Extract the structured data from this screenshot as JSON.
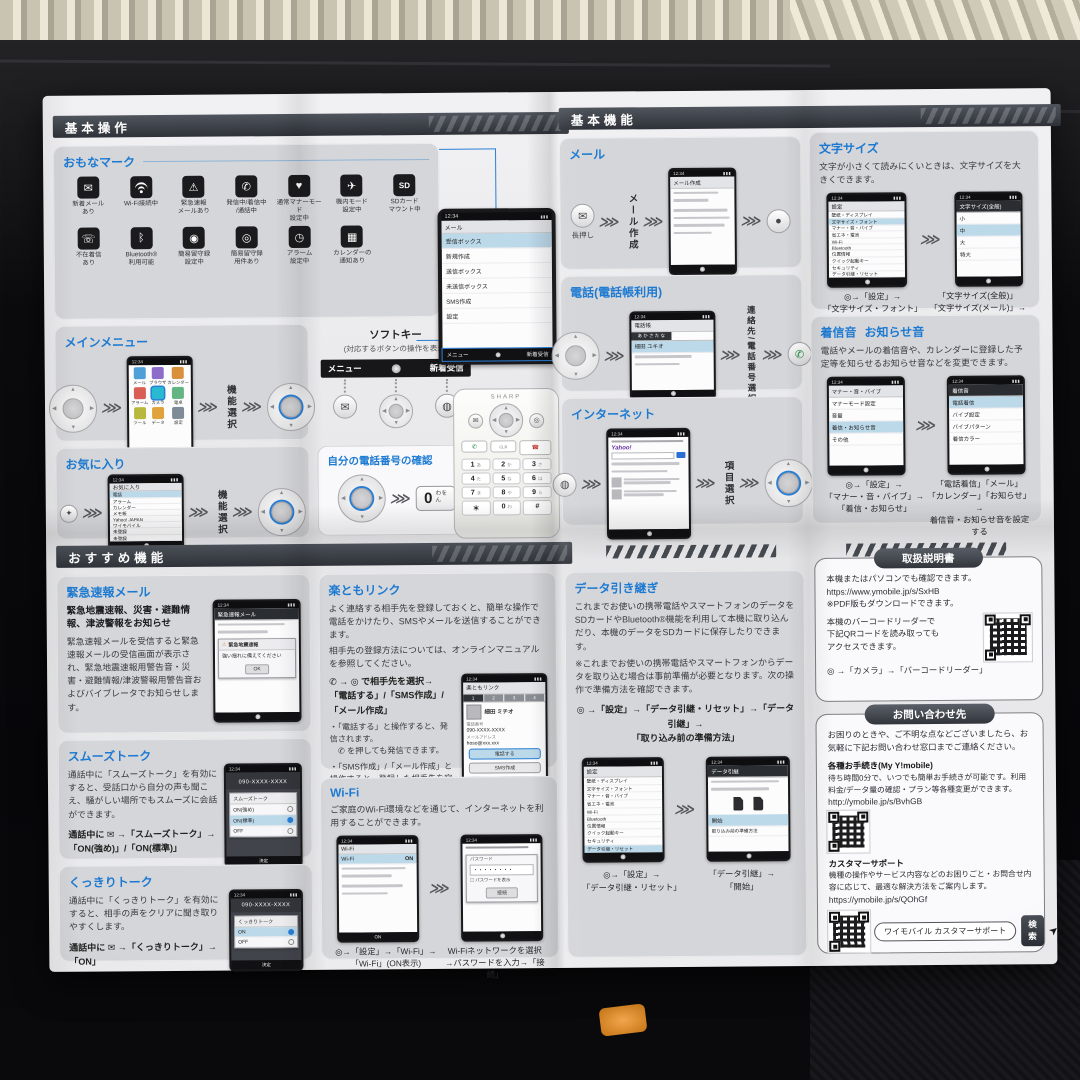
{
  "ui": {
    "time": "12:34",
    "chevron": "⋙",
    "sig": "▮▮▮"
  },
  "colors": {
    "accent": "#1d7ad2",
    "header_bar": "#3a3f46",
    "panel_gray": "#d5d6d9",
    "paper": "#ededef",
    "highlight": "#bcd9ea"
  },
  "p1": {
    "header": "基本操作",
    "marks": {
      "title": "おもなマーク",
      "items": [
        {
          "glyph": "✉",
          "label": "新着メール\nあり"
        },
        {
          "glyph": "",
          "label": "Wi-Fi接続中"
        },
        {
          "glyph": "⚠",
          "label": "緊急速報\nメールあり"
        },
        {
          "glyph": "✆",
          "label": "発信中/着信中\n/通話中"
        },
        {
          "glyph": "♥",
          "label": "通常マナーモード\n設定中"
        },
        {
          "glyph": "✈",
          "label": "機内モード\n設定中"
        },
        {
          "glyph": "SD",
          "label": "SDカード\nマウント中"
        },
        {
          "glyph": "☏",
          "label": "不在着信\nあり"
        },
        {
          "glyph": "ᛒ",
          "label": "Bluetooth®\n利用可能"
        },
        {
          "glyph": "◉",
          "label": "簡易留守録\n設定中"
        },
        {
          "glyph": "◎",
          "label": "簡易留守録\n用件あり"
        },
        {
          "glyph": "◷",
          "label": "アラーム\n設定中"
        },
        {
          "glyph": "▦",
          "label": "カレンダーの\n通知あり"
        }
      ]
    },
    "main_menu": {
      "title": "メインメニュー",
      "select": "機能選択",
      "tiles": [
        "メール",
        "ブラウザ",
        "カレンダー",
        "アラーム",
        "カメラ",
        "電卓",
        "ツール",
        "データ",
        "設定"
      ]
    },
    "favorites": {
      "title": "お気に入り",
      "select": "機能選択",
      "screen_title": "お気に入り",
      "rows": [
        "電話",
        "アラーム",
        "カレンダー",
        "メモ帳",
        "Yahoo! JAPAN",
        "ワイモバイル",
        "未登録",
        "未登録",
        "未登録"
      ]
    },
    "softkey": {
      "title": "ソフトキー",
      "subtitle": "(対応するボタンの操作を表示)",
      "left": "メニュー",
      "right": "新着受信"
    },
    "my_number": {
      "title": "自分の電話番号の確認",
      "zero": "0",
      "zero_sub": "わを\nん"
    },
    "mail_screen": {
      "title": "メール",
      "rows": [
        "受信ボックス",
        "新規作成",
        "送信ボックス",
        "未送信ボックス",
        "SMS作成",
        "設定"
      ]
    }
  },
  "p2": {
    "header": "基本機能",
    "mail": {
      "title": "メール",
      "press": "長押し",
      "step": "メール作成",
      "screen_title": "メール作成"
    },
    "phone": {
      "title": "電話(電話帳利用)",
      "step": "連絡先/電話番号選択",
      "screen_title": "電話帳",
      "tabs": "あ か さ た な",
      "entry": "細田 ユキオ"
    },
    "internet": {
      "title": "インターネット",
      "step": "項目選択",
      "logo": "Yahoo!"
    },
    "settings_title": "設定",
    "settings_rows": [
      "壁紙・ディスプレイ",
      "文字サイズ・フォント",
      "マナー・音・バイブ",
      "省エネ・電池",
      "Wi-Fi",
      "Bluetooth",
      "位置情報",
      "クイック起動キー",
      "セキュリティ",
      "データ引継・リセット"
    ],
    "text_size": {
      "title": "文字サイズ",
      "desc": "文字が小さくて読みにくいときは、文字サイズを大きくできます。",
      "cap1": "◎→「設定」→\n「文字サイズ・フォント」",
      "cap2": "「文字サイズ(全般)」\n「文字サイズ(メール)」→\n文字サイズを選択",
      "screen2_title": "文字サイズ(全般)",
      "sizes": [
        "小",
        "中",
        "大",
        "特大"
      ]
    },
    "ringtone": {
      "title1": "着信音",
      "title2": "お知らせ音",
      "desc": "電話やメールの着信音や、カレンダーに登録した予定等を知らせるお知らせ音などを変更できます。",
      "cap1": "◎→「設定」→\n「マナー・音・バイブ」→\n「着信・お知らせ」",
      "cap2": "「電話着信」「メール」\n「カレンダー」「お知らせ」→\n着信音・お知らせ音を設定する",
      "screen1_title": "マナー・音・バイブ",
      "screen1_rows": [
        "マナーモード設定",
        "音量",
        "着信・お知らせ音",
        "その他"
      ],
      "screen2_title": "着信音",
      "screen2_rows": [
        "電話着信",
        "バイブ設定",
        "バイブパターン",
        "着信カラー"
      ]
    }
  },
  "p3": {
    "header": "おすすめ機能",
    "emergency": {
      "title": "緊急速報メール",
      "lead": "緊急地震速報、災害・避難情報、津波警報をお知らせ",
      "body": "緊急速報メールを受信すると緊急速報メールの受信画面が表示され、緊急地震速報用警告音・災害・避難情報/津波警報用警告音およびバイブレータでお知らせします。",
      "screen_title": "緊急速報メール",
      "alert_title": "緊急地震速報",
      "alert_body": "強い揺れに備えてください",
      "ok": "OK"
    },
    "smooth": {
      "title": "スムーズトーク",
      "body": "通話中に「スムーズトーク」を有効にすると、受話口から自分の声も聞こえ、騒がしい場所でもスムーズに会話ができます。",
      "op": "通話中に ✉ →「スムーズトーク」→\n「ON(強め)」/「ON(標準)」",
      "number": "090-XXXX-XXXX",
      "dialog": "スムーズトーク",
      "opts": [
        "ON(強め)",
        "ON(標準)",
        "OFF"
      ],
      "soft": "決定"
    },
    "clear": {
      "title": "くっきりトーク",
      "body": "通話中に「くっきりトーク」を有効にすると、相手の声をクリアに聞き取りやすくします。",
      "op": "通話中に ✉ →「くっきりトーク」→\n「ON」",
      "number": "090-XXXX-XXXX",
      "dialog": "くっきりトーク",
      "opts": [
        "ON",
        "OFF"
      ],
      "soft": "決定"
    },
    "rakutomo": {
      "title": "楽ともリンク",
      "body1": "よく連絡する相手先を登録しておくと、簡単な操作で電話をかけたり、SMSやメールを送信することができます。",
      "body2": "相手先の登録方法については、オンラインマニュアルを参照してください。",
      "op1": "✆ → ◎ で相手先を選択→",
      "op2": "「電話する」/「SMS作成」/「メール作成」",
      "note1": "・「電話する」と操作すると、発信されます。",
      "note2": "　✆ を押しても発信できます。",
      "note3": "・「SMS作成」/「メール作成」と操作すると、登録した相手先を宛先にしたSMS/メールの作成画面が表示されます。",
      "screen_title": "楽ともリンク",
      "tabs": [
        "1",
        "2",
        "3",
        "4"
      ],
      "name": "細田 ミチオ",
      "tel_label": "電話番号",
      "tel": "090-XXXX-XXXX",
      "mail_label": "メールアドレス",
      "mail": "hoso@xxx.xxx",
      "buttons": [
        "電話する",
        "SMS作成",
        "メール作成"
      ]
    },
    "wifi": {
      "title": "Wi-Fi",
      "body": "ご家庭のWi-Fi環境などを通じて、インターネットを利用することができます。",
      "cap1": "◎→「設定」→「Wi-Fi」→\n「Wi-Fi」(ON表示)",
      "cap2": "Wi-Fiネットワークを選択\n→パスワードを入力→「接続」",
      "screen1_title": "Wi-Fi",
      "row_on": "ON",
      "pw_label": "パスワード",
      "pw_dots": "・・・・・・・・",
      "pw_show": "パスワードを表示",
      "connect": "接続"
    },
    "data": {
      "title": "データ引き継ぎ",
      "body": "これまでお使いの携帯電話やスマートフォンのデータをSDカードやBluetooth®機能を利用して本機に取り込んだり、本機のデータをSDカードに保存したりできます。",
      "note": "※これまでお使いの携帯電話やスマートフォンからデータを取り込む場合は事前準備が必要となります。次の操作で準備方法を確認できます。",
      "op": "◎ →「設定」→「データ引継・リセット」→「データ引継」→\n「取り込み前の準備方法」",
      "cap1": "◎→「設定」→\n「データ引継・リセット」",
      "cap2": "「データ引継」→\n「開始」",
      "screen2_title": "データ引継",
      "opt1": "開始",
      "opt2": "取り込み前の準備方法"
    }
  },
  "p4": {
    "manual": {
      "title": "取扱説明書",
      "l1": "本機またはパソコンでも確認できます。",
      "url": "https://www.ymobile.jp/s/SxHB",
      "l2": "※PDF版もダウンロードできます。",
      "l3": "本機のバーコードリーダーで\n下記QRコードを読み取っても\nアクセスできます。",
      "cap": "◎ →「カメラ」→「バーコードリーダー」"
    },
    "contact": {
      "title": "お問い合わせ先",
      "intro": "お困りのときや、ご不明な点などございましたら、お気軽に下記お問い合わせ窓口までご連絡ください。",
      "s1_title": "各種お手続き(My Y!mobile)",
      "s1_body": "待ち時間0分で、いつでも簡単お手続きが可能です。利用料金/データ量の確認・プラン等各種変更ができます。",
      "s1_url": "http://ymobile.jp/s/BvhGB",
      "s2_title": "カスタマーサポート",
      "s2_body": "機種の操作やサービス内容などのお困りごと・お問合せ内容に応じて、最適な解決方法をご案内します。",
      "s2_url": "https://ymobile.jp/s/QOhGf",
      "search_label": "ワイモバイル カスタマーサポート",
      "search_btn": "検索"
    }
  },
  "device": {
    "brand": "SHARP",
    "keys": [
      [
        "1",
        "あ"
      ],
      [
        "2",
        "か"
      ],
      [
        "3",
        "さ"
      ],
      [
        "4",
        "た"
      ],
      [
        "5",
        "な"
      ],
      [
        "6",
        "は"
      ],
      [
        "7",
        "ま"
      ],
      [
        "8",
        "や"
      ],
      [
        "9",
        "ら"
      ],
      [
        "＊",
        ""
      ],
      [
        "0",
        "わ"
      ],
      [
        "#",
        ""
      ]
    ]
  }
}
